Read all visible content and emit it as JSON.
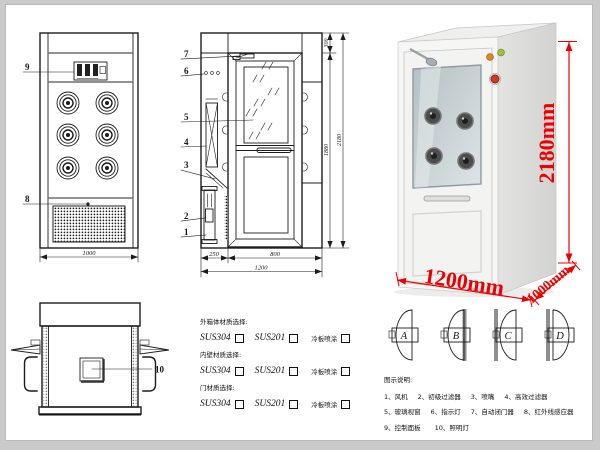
{
  "front_view": {
    "label_control_panel": "9",
    "label_grille": "8",
    "width_dim": "1000"
  },
  "section_view": {
    "part_labels": [
      "7",
      "6",
      "5",
      "4",
      "3",
      "2",
      "1"
    ],
    "dim_left": "250",
    "dim_door": "800",
    "dim_total_width": "1200",
    "dim_top": "300",
    "dim_inner_height": "1880",
    "dim_total_height": "2180"
  },
  "photo": {
    "height_label": "2180mm",
    "width_label": "1200mm",
    "depth_label": "1000mm",
    "dim_color": "#ee0000"
  },
  "top_view": {
    "label_window": "10"
  },
  "materials": {
    "sections": [
      {
        "title": "外箱体材质选择:",
        "opt1": "SUS304",
        "opt2": "SUS201",
        "opt3": "冷板喷涂"
      },
      {
        "title": "内壁材质选择:",
        "opt1": "SUS304",
        "opt2": "SUS201",
        "opt3": "冷板喷涂"
      },
      {
        "title": "门材质选择:",
        "opt1": "SUS304",
        "opt2": "SUS201",
        "opt3": "冷板喷涂"
      }
    ]
  },
  "door_types": {
    "a": "A",
    "b": "B",
    "c": "C",
    "d": "D"
  },
  "legend": {
    "title": "图示说明:",
    "row1": [
      "1、风机",
      "2、初级过滤器",
      "3、喷嘴",
      "4、高效过滤器"
    ],
    "row2": [
      "5、玻璃视窗",
      "6、指示灯",
      "7、自动闭门器",
      "8、红外线感应器"
    ],
    "row3": [
      "9、控制面板",
      "10、照明灯"
    ]
  }
}
